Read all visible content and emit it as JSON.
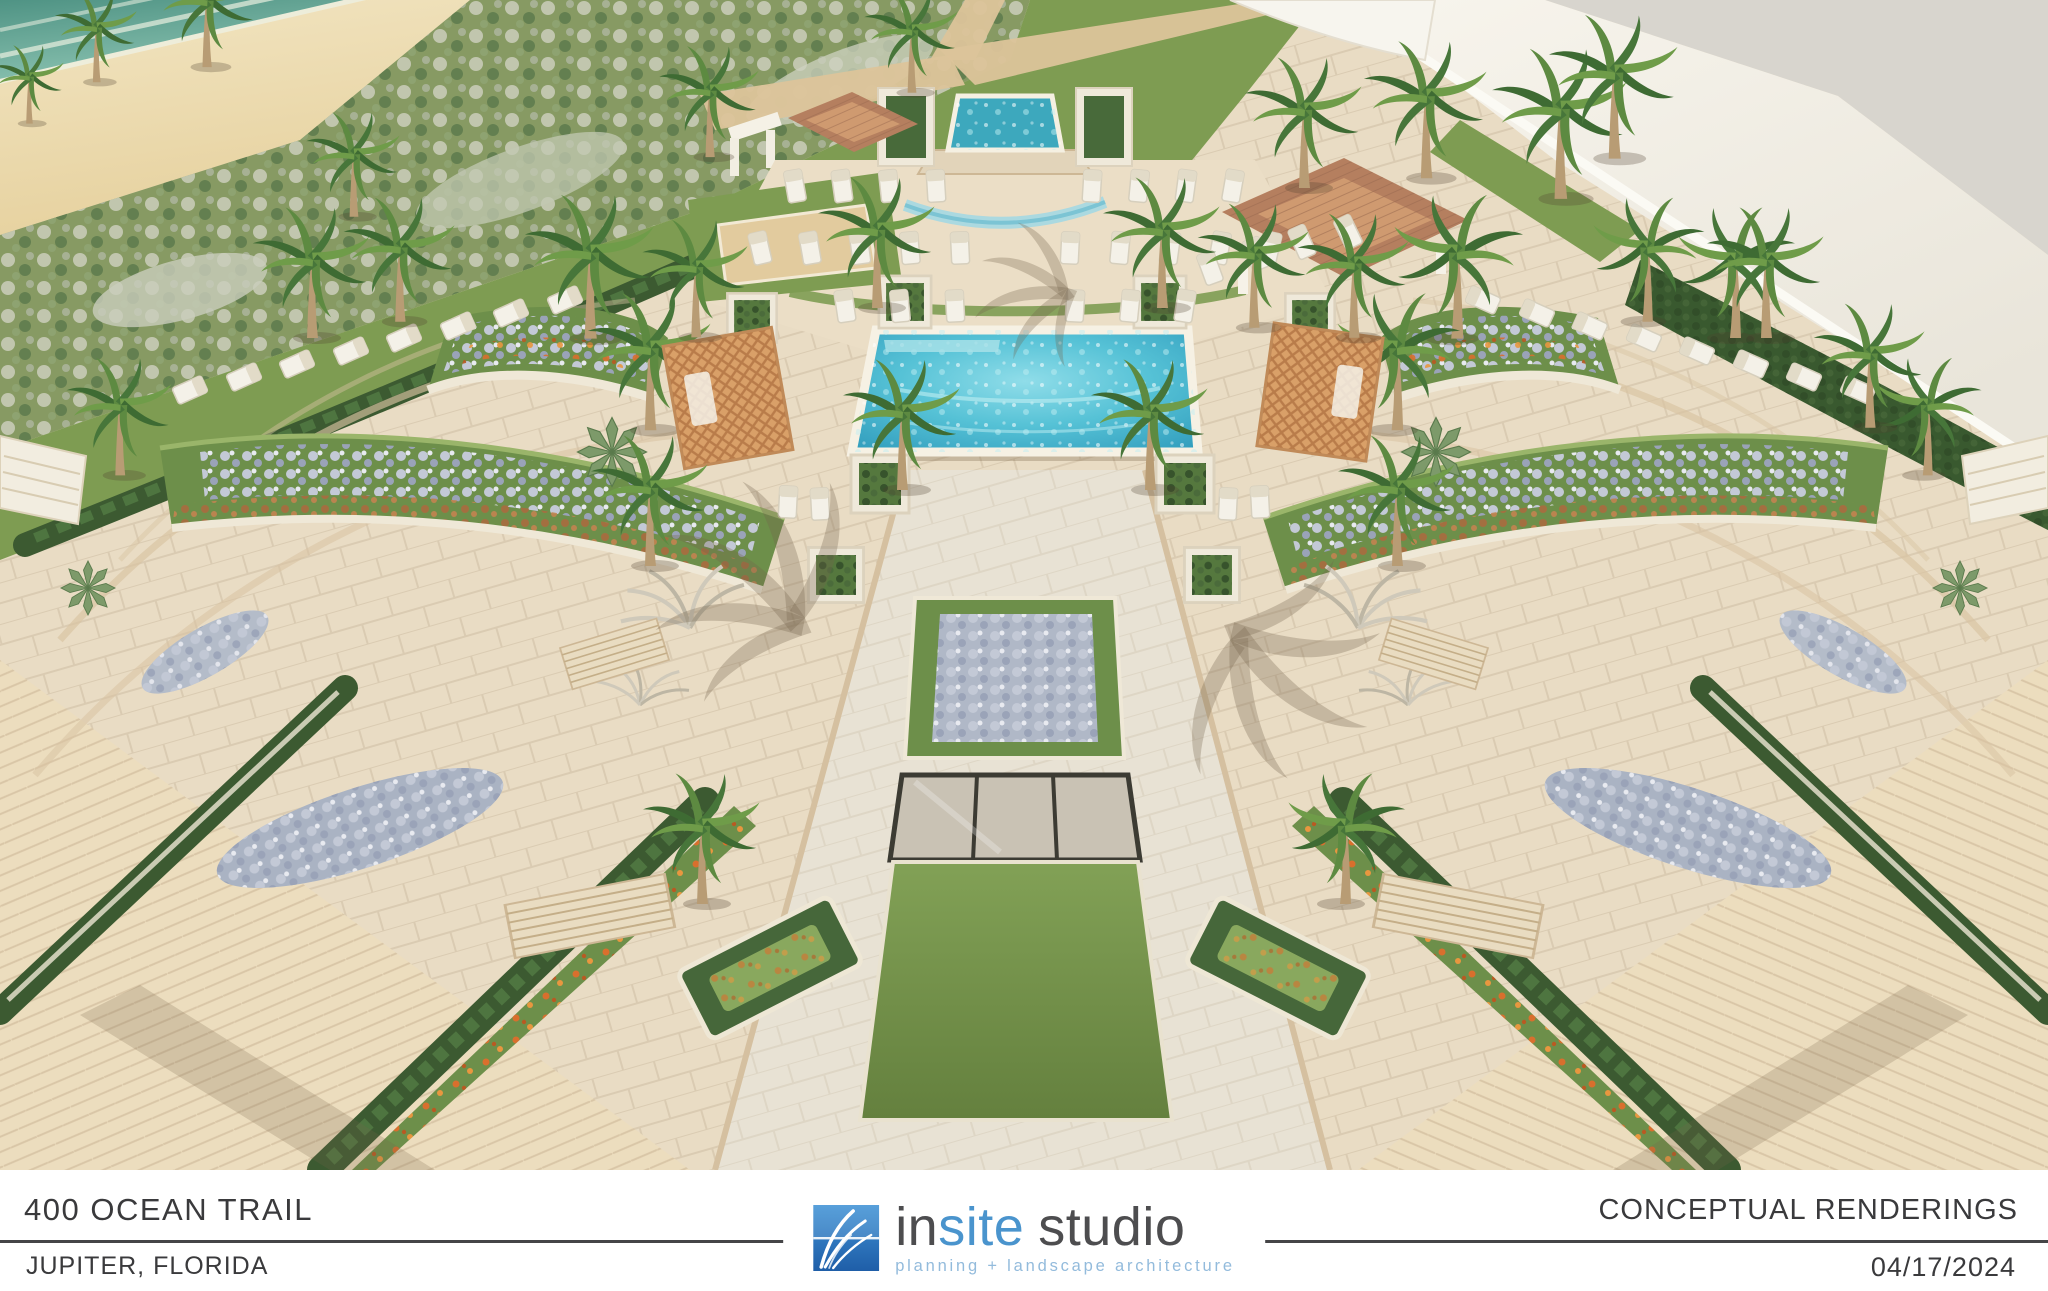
{
  "title_block": {
    "project_name": "400 OCEAN TRAIL",
    "project_location": "JUPITER, FLORIDA",
    "sheet_title": "CONCEPTUAL RENDERINGS",
    "sheet_date": "04/17/2024"
  },
  "logo": {
    "word_insite_prefix": "in",
    "word_insite_suffix": "site",
    "word_studio": "studio",
    "tagline": "planning + landscape architecture",
    "colors": {
      "square_blue_top": "#4193d6",
      "square_blue_bottom": "#1f5ea8",
      "text_gray": "#4d4d4f",
      "text_blue": "#4a94cd",
      "tagline_blue": "#93bbdc"
    }
  },
  "scene": {
    "type": "aerial conceptual landscape rendering",
    "elements": [
      "ocean",
      "beach",
      "dune planting",
      "event lawn",
      "spa fountain",
      "main pool",
      "pool deck",
      "trellis cabanas",
      "terracotta pavilion",
      "palm trees",
      "lounge chairs",
      "hedge planters",
      "central flower bed",
      "skylight panels",
      "central lawn panel",
      "paver plaza",
      "building roof"
    ],
    "palette": {
      "paver": "#e9dcc4",
      "walkway": "#e8e2d4",
      "lawn": "#7e9c52",
      "hedge": "#3c5a31",
      "pool_water": "#56c2d6",
      "ocean": "#6fae9e",
      "sand": "#eddcb0",
      "roof_terracotta": "#b57f5f",
      "trellis_orange": "#d49a66",
      "flower_silver": "#aeb6c6",
      "flower_orange": "#d4702e",
      "building": "#f4f1e8"
    }
  }
}
